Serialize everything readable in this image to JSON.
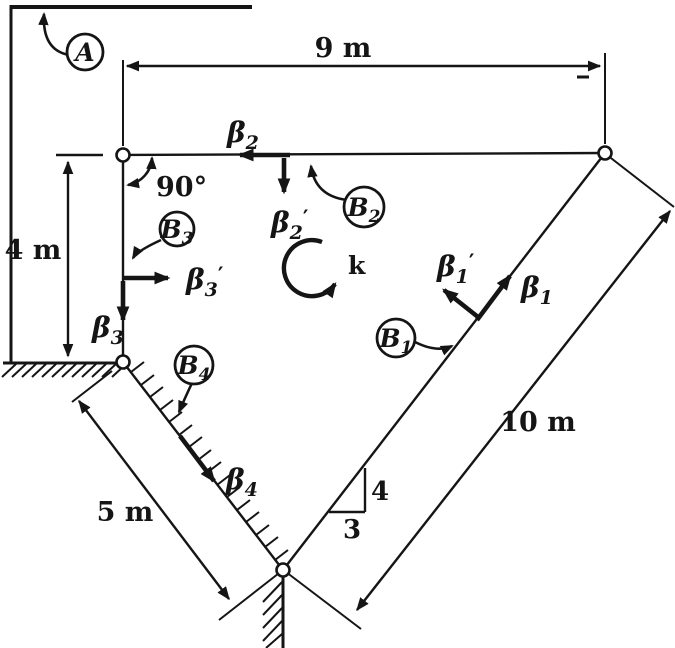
{
  "colors": {
    "ink": "#151515",
    "paper": "#ffffff"
  },
  "dimensions": {
    "top": "9 m",
    "left": "4 m",
    "incline": "5 m",
    "hypotenuse": "10 m"
  },
  "angle": {
    "right_angle": "90°"
  },
  "slope_triangle": {
    "rise": "4",
    "run": "3"
  },
  "rotation": {
    "axis_vector": "k"
  },
  "joint_labels": {
    "A": {
      "base": "A",
      "sub": ""
    },
    "B1": {
      "base": "B",
      "sub": "1"
    },
    "B2": {
      "base": "B",
      "sub": "2"
    },
    "B3": {
      "base": "B",
      "sub": "3"
    },
    "B4": {
      "base": "B",
      "sub": "4"
    }
  },
  "unit_vectors": {
    "beta1": {
      "base": "β",
      "sub": "1",
      "prime": ""
    },
    "beta1_prime": {
      "base": "β",
      "sub": "1",
      "prime": "′"
    },
    "beta2": {
      "base": "β",
      "sub": "2",
      "prime": ""
    },
    "beta2_prime": {
      "base": "β",
      "sub": "2",
      "prime": "′"
    },
    "beta3": {
      "base": "β",
      "sub": "3",
      "prime": ""
    },
    "beta3_prime": {
      "base": "β",
      "sub": "3",
      "prime": "′"
    },
    "beta4": {
      "base": "β",
      "sub": "4",
      "prime": ""
    }
  }
}
